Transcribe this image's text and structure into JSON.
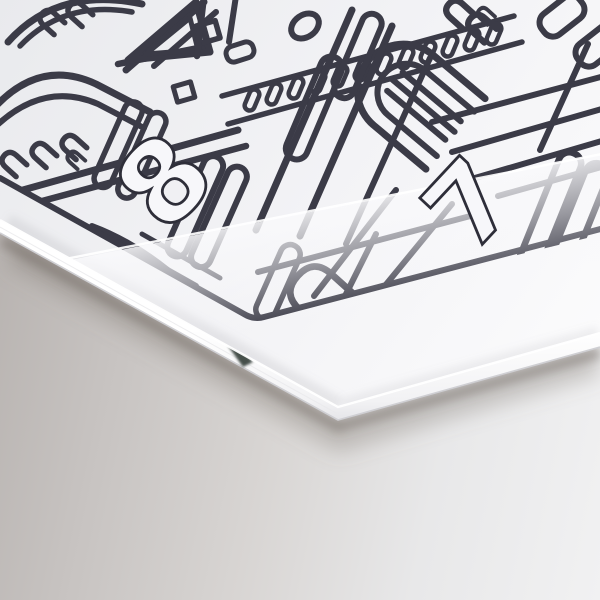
{
  "scene": {
    "description": "Close-up mockup photograph of thick printed boards at a grazing angle on a gray studio surface",
    "print": {
      "illustration": "cathedral facade line art (arches, colonnade, pediment, rose window, lancet windows)",
      "number_top_card": "8",
      "number_band": "7"
    },
    "colors": {
      "ink": "#3b3b47",
      "faded_ink_under_band": "#9a9aa3",
      "card_surface": "#f2f2f5",
      "card_edge_highlight": "#ffffff",
      "edge_lip": "#cfcfd3",
      "edge_notch": "#39433d",
      "background_left": "#b3aeab",
      "background_right": "#f1f1f2",
      "shadow": "#6c645d"
    }
  }
}
